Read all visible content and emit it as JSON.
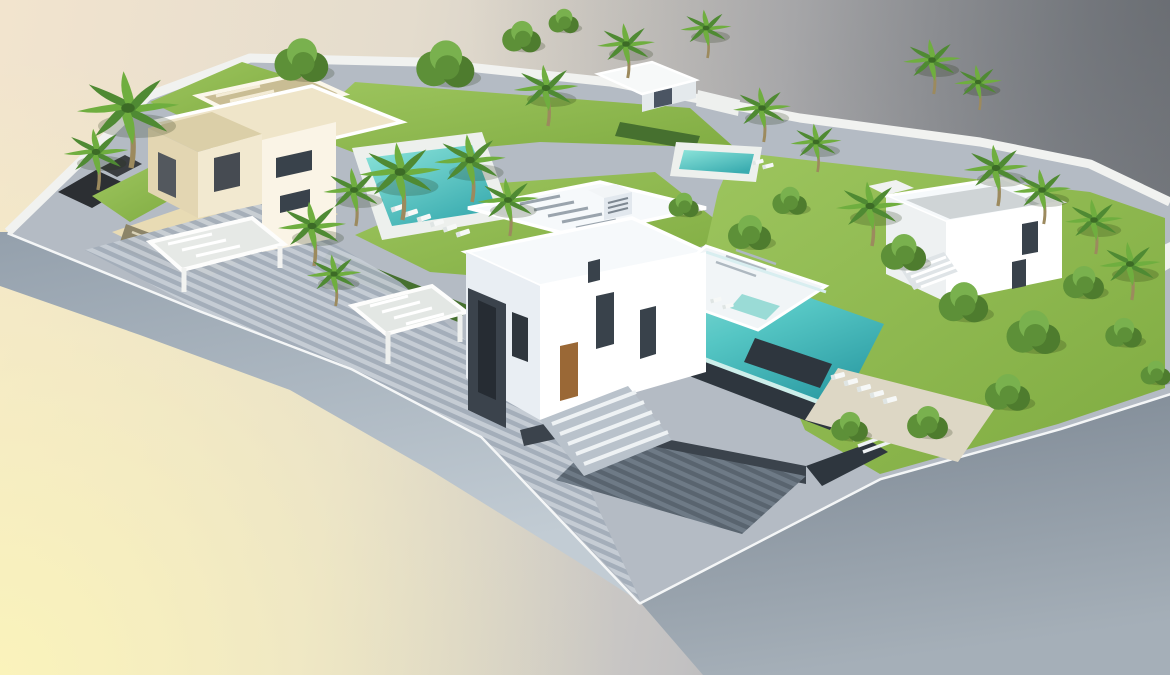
{
  "meta": {
    "title": "Aerial 3D architectural rendering of a floating landscaped villa plot",
    "type": "photorealistic CGI render, isometric aerial view",
    "visible_text": "none"
  },
  "palette": {
    "bg_warm_corner": "#faf3bb",
    "bg_cream": "#f2e4ce",
    "bg_gray": "#989ba0",
    "bg_gray_dark": "#84878c",
    "cliff_light": "#c2ccd4",
    "cliff_mid": "#94a0ac",
    "cliff_dark": "#7b8692",
    "rim_white": "#f4f6f7",
    "paving": "#b4bbc4",
    "plank_light": "#c6cdd5",
    "plank_dark": "#a3adb9",
    "courtyard_light": "#6e7a86",
    "courtyard_dark": "#59646f",
    "wall_white": "#f1f2f0",
    "lawn": "#7fab41",
    "lawn_light": "#9dc55e",
    "hedge": "#46702f",
    "pool_light": "#8ce4da",
    "pool_deep": "#3aacb0",
    "pool_deck": "#edf0ed",
    "deck_beige": "#ddd7c5",
    "patio_beige": "#e8dbb4",
    "villa_white": "#ffffff",
    "villa_shade": "#e9eef3",
    "roof_white": "#f6f9fb",
    "beige_wall": "#e3d6b2",
    "beige_light": "#f2e9d0",
    "beige_roof": "#dbcfa8",
    "cream_roof": "#efe5c9",
    "slate": "#3b434c",
    "slate_deep": "#2e363e",
    "window": "#39424b",
    "wood_door": "#9a6836",
    "trunk": "#9c8a5e",
    "palm": "#6fae3f",
    "palm_dark": "#4f8a33",
    "tree": "#5d9038",
    "tree_dark": "#4e7c2e",
    "tree_light": "#79b14e",
    "glass": "#cdeeea"
  },
  "scene": {
    "background": {
      "style": "studio gradient",
      "bottom_left": "warm pale yellow",
      "top_right": "neutral dark gray"
    },
    "island": {
      "label": "cut-away floating terrain block",
      "edges": "smooth curved light blue-gray cliff faces with thin white rim"
    },
    "buildings": [
      {
        "id": "left-villa",
        "label": "beige travertine villa with rooftop pergola, carport pergola and sunken ramp",
        "storeys": 2
      },
      {
        "id": "center-villa",
        "label": "large white contemporary villa with dark slate entry wall, wood door, roof terrace with jacuzzi and glass-edged infinity pool",
        "storeys": 3
      },
      {
        "id": "right-villa",
        "label": "white cubic villa with external staircase and gray roof deck",
        "storeys": 2
      },
      {
        "id": "garden-pavilion",
        "label": "small white flat-roof pavilion on rear boundary wall",
        "storeys": 1
      }
    ],
    "pools": [
      {
        "id": "lap-pool",
        "label": "turquoise lap pool with white surround deck and sun loungers"
      },
      {
        "id": "infinity-pool",
        "label": "large turquoise infinity pool with transparent glass edge and dark counter block"
      },
      {
        "id": "rear-pool",
        "label": "small turquoise pool in rear neighbouring garden"
      }
    ],
    "landscape": {
      "lawns": "bright green manicured lawns",
      "palm_trees": 20,
      "round_trees": 16,
      "hedges": "clipped dark-green hedge rows along paths",
      "paving": "gray plank-effect paving, driveway and sunken slate-walled courtyard",
      "perimeter": "white boundary walls with short dark stone segments"
    },
    "furniture": {
      "sun_loungers": "rows of white sun loungers at lap pool, sun deck, rear pool and roof terrace",
      "pergolas": 3,
      "stairs": "white exterior stairs at centre courtyard, right garden and right villa"
    }
  }
}
